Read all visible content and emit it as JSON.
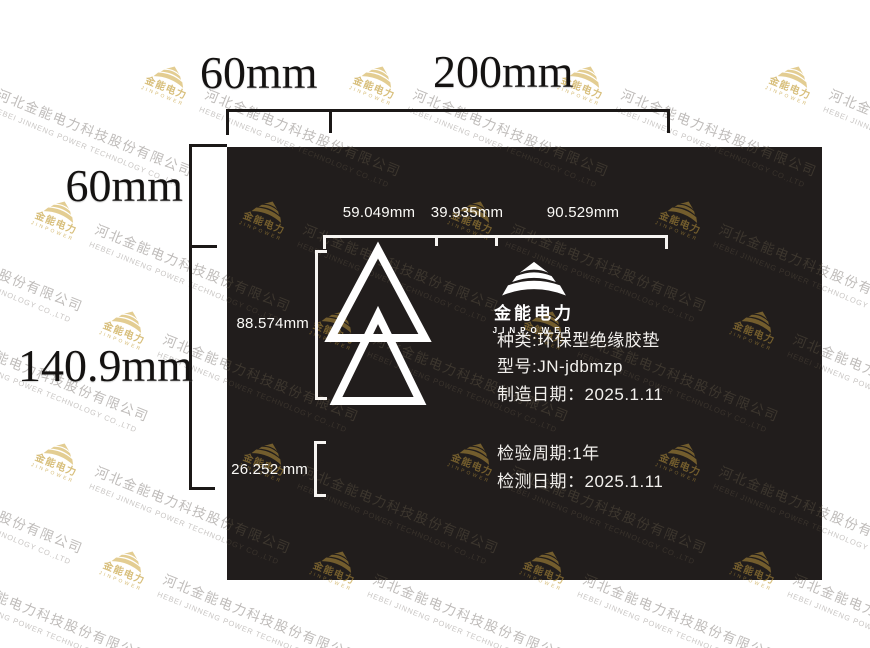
{
  "watermark": {
    "company_cn": "河北金能电力科技股份有限公司",
    "company_en": "HEBEI JINNENG POWER TECHNOLOGY CO.,LTD",
    "logo_cn": "金能电力",
    "logo_en": "JINPOWER",
    "gold_color": "#d8bf7c",
    "gray_color": "#bfbcba"
  },
  "outer_dims": {
    "top_left": "60mm",
    "top_right": "200mm",
    "side_top": "60mm",
    "side_bottom": "140.9mm"
  },
  "inner_dims": {
    "top_segments": [
      "59.049mm",
      "39.935mm",
      "90.529mm"
    ],
    "symbol_height": "88.574mm",
    "bottom_gap": "26.252 mm"
  },
  "brand": {
    "name_cn": "金能电力",
    "name_en": "JINPOWER"
  },
  "spec": {
    "lines": [
      "种类:环保型绝缘胶垫",
      "型号:JN-jdbmzp",
      "制造日期：2025.1.11",
      "检验周期:1年",
      "检测日期：2025.1.11"
    ]
  },
  "colors": {
    "sheet_background": "#211d1c",
    "sheet_text": "#f2f0ed",
    "dimension_ink": "#1b1817"
  }
}
